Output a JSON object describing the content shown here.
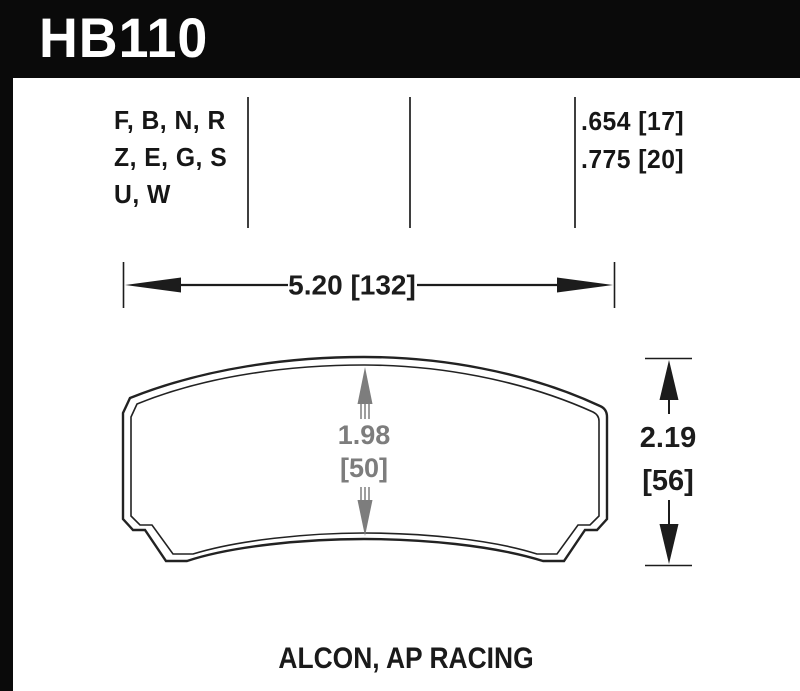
{
  "banner": {
    "part_number": "HB110",
    "bg_color": "#0a0a0a",
    "text_color": "#ffffff"
  },
  "compound_table": {
    "compound_rows": [
      "F, B, N, R",
      "Z, E, G, S",
      "U, W"
    ],
    "thickness_rows": [
      ".654 [17]",
      ".775 [20]"
    ]
  },
  "dimensions": {
    "width": "5.20 [132]",
    "pad_height": {
      "line1": "1.98",
      "line2": "[50]"
    },
    "overall_height": {
      "line1": "2.19",
      "line2": "[56]"
    }
  },
  "footer": {
    "applications": "ALCON, AP RACING"
  },
  "colors": {
    "outline_black": "#222222",
    "dimension_black": "#1c1c1c",
    "dimension_gray": "#7d7d7d",
    "separator_gray": "#3f3f3f"
  }
}
